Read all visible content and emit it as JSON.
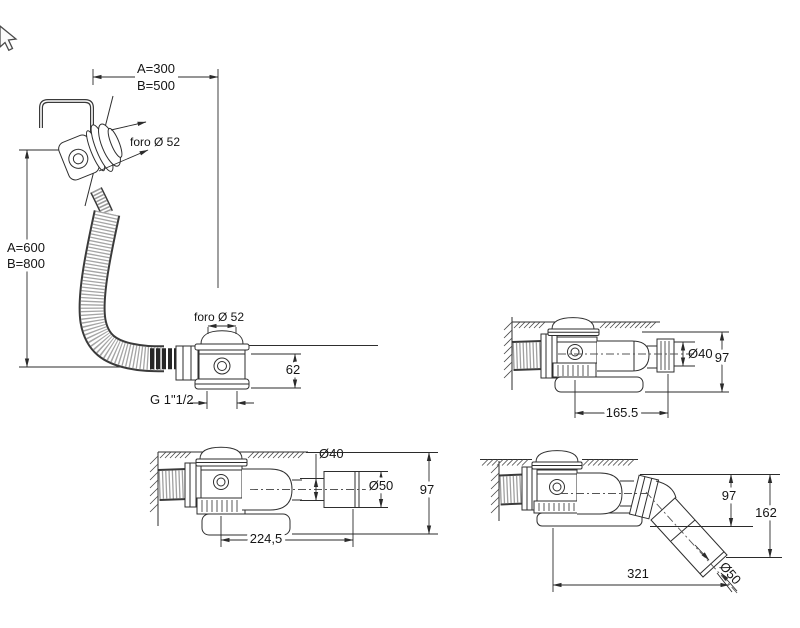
{
  "cursor": {
    "icon": "arrow-pointer-icon"
  },
  "drawings": {
    "main_view": {
      "dim_top_a": "A=300",
      "dim_top_b": "B=500",
      "dim_left_a": "A=600",
      "dim_left_b": "B=800",
      "overflow_hole": "foro Ø 52",
      "drain_hole": "foro Ø 52",
      "drain_height": "62",
      "outlet_thread": "G 1\"1/2"
    },
    "horizontal_outlet_view": {
      "outlet_diameter": "Ø40",
      "height": "97",
      "length": "165.5"
    },
    "extended_outlet_view": {
      "pipe_diameter": "Ø40",
      "end_diameter": "Ø50",
      "height": "97",
      "length": "224,5"
    },
    "angled_outlet_view": {
      "body_height": "97",
      "total_height": "162",
      "length": "321",
      "end_diameter": "Ø50"
    }
  }
}
